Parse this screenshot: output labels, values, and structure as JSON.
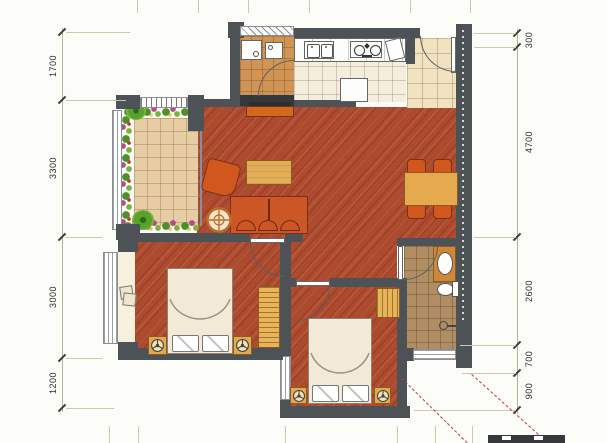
{
  "page": {
    "title": "Apartment Floor Plan"
  },
  "dimensions": {
    "left": [
      {
        "label": "1700"
      },
      {
        "label": "3300"
      },
      {
        "label": "3000"
      },
      {
        "label": "1200"
      }
    ],
    "right": [
      {
        "label": "300"
      },
      {
        "label": "4700"
      },
      {
        "label": "2600"
      },
      {
        "label": "700"
      },
      {
        "label": "900"
      }
    ]
  },
  "rooms": [
    {
      "name": "balcony"
    },
    {
      "name": "living-dining-room"
    },
    {
      "name": "kitchen"
    },
    {
      "name": "laundry-room"
    },
    {
      "name": "entry-hall"
    },
    {
      "name": "bathroom"
    },
    {
      "name": "bedroom"
    },
    {
      "name": "master-bedroom"
    },
    {
      "name": "bay-window"
    }
  ],
  "colors": {
    "wall": "#4d5257",
    "wood_floor": "#ae4a2d",
    "kitchen_floor": "#f5eedc",
    "entry_floor": "#f1e3c0",
    "laundry_floor": "#d09554",
    "bath_floor": "#b18d63",
    "balcony_floor": "#e7cda4",
    "furniture_orange": "#d2571e",
    "wood_light": "#e3ae58",
    "bed_linen": "#f2ead6",
    "leader_dashed": "#c13a4a",
    "dimension_line": "#b9b296"
  }
}
